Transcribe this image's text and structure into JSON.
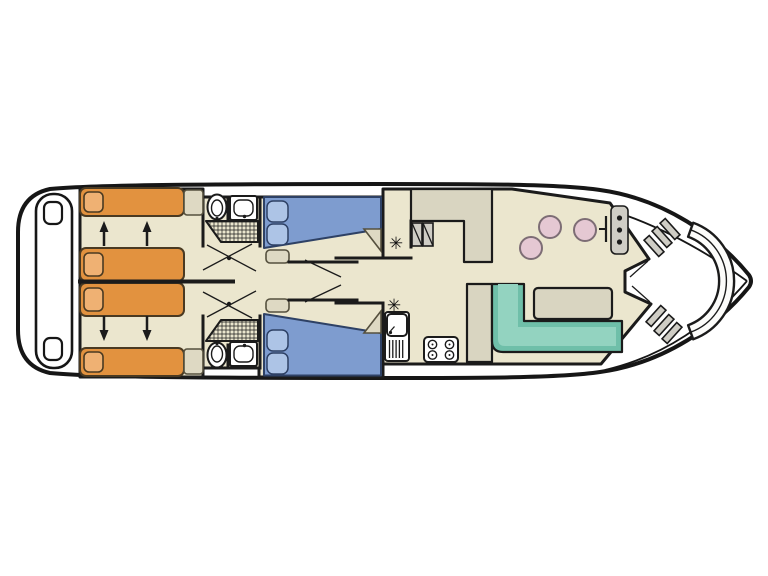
{
  "colors": {
    "hull_outline": "#161616",
    "wall": "#1b1b1b",
    "floor": "#ebe6ce",
    "counter": "#d9d5c1",
    "bed_orange": "#e2923f",
    "pillow_orange": "#efb173",
    "bed_frame": "#4a3a22",
    "bed_blue": "#7e9ccf",
    "pillow_blue": "#adc4e6",
    "blue_frame": "#2e4165",
    "tan_box": "#ded9c3",
    "sofa_dark": "#6fbfa9",
    "sofa_light": "#93d3c0",
    "stool_pink": "#e5c8d3",
    "stool_edge": "#7d6d75",
    "fixture_gray": "#cfcdc5",
    "step_gray": "#d6d3c6"
  },
  "symbols": {
    "heater": "✳"
  }
}
